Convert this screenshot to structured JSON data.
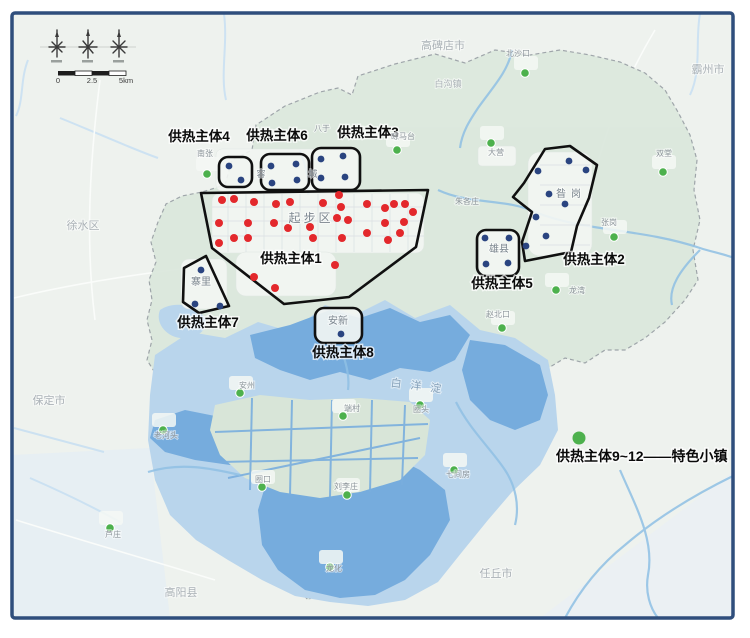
{
  "title": "雄安新区供热主体分布图",
  "colors": {
    "red": "#e3282c",
    "blue": "#2a4480",
    "green": "#4db14d",
    "outline": "#101010",
    "frame": "#2f4e7c",
    "entity_label": "#0a0a0a",
    "city_label": "#abb2b7",
    "town_label": "#8d959b",
    "inner_label": "#7b858e",
    "lake_label": "#87a2ba",
    "lake_dark": "#76acdd",
    "lake_light": "#b9d5ec",
    "region_fill": "#dce8dd"
  },
  "entities": [
    {
      "id": "1",
      "label": "供热主体1",
      "shape": "polygon",
      "points": "201,193 428,190 416,247 349,297 284,304 212,248",
      "label_x": 291,
      "label_y": 263
    },
    {
      "id": "2",
      "label": "供热主体2",
      "shape": "polygon",
      "points": "545,149 570,146 597,165 589,198 577,226 571,252 525,261 522,242 532,212 513,197 524,183",
      "label_x": 594,
      "label_y": 264
    },
    {
      "id": "3",
      "label": "供热主体3",
      "shape": "rect",
      "x": 312,
      "y": 148,
      "w": 48,
      "h": 42,
      "label_x": 368,
      "label_y": 137
    },
    {
      "id": "4",
      "label": "供热主体4",
      "shape": "rect",
      "x": 219,
      "y": 157,
      "w": 33,
      "h": 30,
      "label_x": 199,
      "label_y": 141
    },
    {
      "id": "5",
      "label": "供热主体5",
      "shape": "rect",
      "x": 477,
      "y": 230,
      "w": 42,
      "h": 46,
      "label_x": 502,
      "label_y": 288
    },
    {
      "id": "6",
      "label": "供热主体6",
      "shape": "rect",
      "x": 261,
      "y": 154,
      "w": 48,
      "h": 36,
      "label_x": 277,
      "label_y": 140
    },
    {
      "id": "7",
      "label": "供热主体7",
      "shape": "polygon",
      "points": "206,256 229,306 199,313 183,302 184,268",
      "label_x": 208,
      "label_y": 327
    },
    {
      "id": "8",
      "label": "供热主体8",
      "shape": "rect",
      "x": 315,
      "y": 308,
      "w": 47,
      "h": 35,
      "label_x": 343,
      "label_y": 357
    }
  ],
  "dots": {
    "red": [
      [
        222,
        200
      ],
      [
        234,
        199
      ],
      [
        254,
        202
      ],
      [
        276,
        204
      ],
      [
        290,
        202
      ],
      [
        323,
        203
      ],
      [
        339,
        195
      ],
      [
        341,
        207
      ],
      [
        367,
        204
      ],
      [
        385,
        208
      ],
      [
        394,
        204
      ],
      [
        405,
        204
      ],
      [
        413,
        212
      ],
      [
        219,
        223
      ],
      [
        248,
        223
      ],
      [
        274,
        223
      ],
      [
        288,
        228
      ],
      [
        310,
        227
      ],
      [
        337,
        218
      ],
      [
        348,
        220
      ],
      [
        385,
        223
      ],
      [
        404,
        222
      ],
      [
        400,
        233
      ],
      [
        219,
        243
      ],
      [
        234,
        238
      ],
      [
        248,
        238
      ],
      [
        313,
        238
      ],
      [
        342,
        238
      ],
      [
        367,
        233
      ],
      [
        388,
        240
      ],
      [
        335,
        265
      ],
      [
        254,
        277
      ],
      [
        275,
        288
      ]
    ],
    "blue": [
      [
        229,
        166
      ],
      [
        241,
        180
      ],
      [
        271,
        166
      ],
      [
        296,
        164
      ],
      [
        272,
        183
      ],
      [
        297,
        180
      ],
      [
        321,
        159
      ],
      [
        343,
        156
      ],
      [
        321,
        178
      ],
      [
        345,
        177
      ],
      [
        538,
        171
      ],
      [
        569,
        161
      ],
      [
        586,
        170
      ],
      [
        549,
        194
      ],
      [
        565,
        204
      ],
      [
        536,
        217
      ],
      [
        546,
        236
      ],
      [
        526,
        246
      ],
      [
        485,
        238
      ],
      [
        509,
        238
      ],
      [
        486,
        264
      ],
      [
        508,
        263
      ],
      [
        201,
        270
      ],
      [
        195,
        304
      ],
      [
        220,
        306
      ],
      [
        341,
        334
      ]
    ],
    "green": [
      [
        207,
        174
      ],
      [
        397,
        150
      ],
      [
        525,
        73
      ],
      [
        491,
        143
      ],
      [
        663,
        172
      ],
      [
        614,
        237
      ],
      [
        556,
        290
      ],
      [
        502,
        328
      ],
      [
        240,
        393
      ],
      [
        343,
        416
      ],
      [
        420,
        405
      ],
      [
        163,
        430
      ],
      [
        110,
        528
      ],
      [
        347,
        495
      ],
      [
        262,
        487
      ],
      [
        330,
        567
      ],
      [
        454,
        470
      ]
    ]
  },
  "place_labels": [
    {
      "t": "高碑店市",
      "x": 443,
      "y": 49,
      "s": 11,
      "c": "city"
    },
    {
      "t": "霸州市",
      "x": 708,
      "y": 73,
      "s": 11,
      "c": "city"
    },
    {
      "t": "徐水区",
      "x": 83,
      "y": 229,
      "s": 11,
      "c": "city"
    },
    {
      "t": "保定市",
      "x": 49,
      "y": 404,
      "s": 11,
      "c": "city"
    },
    {
      "t": "高阳县",
      "x": 181,
      "y": 596,
      "s": 11,
      "c": "city"
    },
    {
      "t": "任丘市",
      "x": 496,
      "y": 577,
      "s": 11,
      "c": "city"
    },
    {
      "t": "白沟镇",
      "x": 448,
      "y": 87,
      "s": 9,
      "c": "city"
    },
    {
      "t": "南张",
      "x": 205,
      "y": 156,
      "s": 8,
      "c": "town"
    },
    {
      "t": "八于",
      "x": 322,
      "y": 131,
      "s": 8,
      "c": "town"
    },
    {
      "t": "晾马台",
      "x": 403,
      "y": 139,
      "s": 8,
      "c": "town"
    },
    {
      "t": "北沙口",
      "x": 518,
      "y": 56,
      "s": 8,
      "c": "town"
    },
    {
      "t": "大营",
      "x": 496,
      "y": 155,
      "s": 8,
      "c": "town"
    },
    {
      "t": "双堂",
      "x": 664,
      "y": 156,
      "s": 8,
      "c": "town"
    },
    {
      "t": "张岗",
      "x": 609,
      "y": 225,
      "s": 8,
      "c": "town"
    },
    {
      "t": "朱各庄",
      "x": 467,
      "y": 204,
      "s": 8,
      "c": "town"
    },
    {
      "t": "龙湾",
      "x": 577,
      "y": 293,
      "s": 8,
      "c": "town"
    },
    {
      "t": "赵北口",
      "x": 498,
      "y": 317,
      "s": 8,
      "c": "town"
    },
    {
      "t": "安州",
      "x": 247,
      "y": 388,
      "s": 8,
      "c": "town"
    },
    {
      "t": "端村",
      "x": 352,
      "y": 411,
      "s": 8,
      "c": "town"
    },
    {
      "t": "圈头",
      "x": 421,
      "y": 412,
      "s": 8,
      "c": "town"
    },
    {
      "t": "七间房",
      "x": 458,
      "y": 477,
      "s": 8,
      "c": "town"
    },
    {
      "t": "刘李庄",
      "x": 346,
      "y": 489,
      "s": 8,
      "c": "town"
    },
    {
      "t": "圈口",
      "x": 263,
      "y": 482,
      "s": 8,
      "c": "town"
    },
    {
      "t": "龙化",
      "x": 334,
      "y": 571,
      "s": 8,
      "c": "town"
    },
    {
      "t": "芦庄",
      "x": 113,
      "y": 537,
      "s": 8,
      "c": "town"
    },
    {
      "t": "老河头",
      "x": 166,
      "y": 438,
      "s": 8,
      "c": "town"
    },
    {
      "t": "容",
      "x": 261,
      "y": 177,
      "s": 9,
      "c": "inner"
    },
    {
      "t": "城",
      "x": 313,
      "y": 177,
      "s": 9,
      "c": "inner"
    },
    {
      "t": "起步区",
      "x": 311,
      "y": 222,
      "s": 12,
      "c": "inner",
      "ls": 3
    },
    {
      "t": "昝岗",
      "x": 571,
      "y": 197,
      "s": 10,
      "c": "inner",
      "ls": 5
    },
    {
      "t": "雄县",
      "x": 499,
      "y": 252,
      "s": 10,
      "c": "inner"
    },
    {
      "t": "安新",
      "x": 338,
      "y": 324,
      "s": 10,
      "c": "inner"
    },
    {
      "t": "寨里",
      "x": 201,
      "y": 285,
      "s": 10,
      "c": "inner"
    },
    {
      "t": "白洋淀",
      "x": 420,
      "y": 390,
      "s": 11,
      "c": "lake",
      "ls": 9,
      "r": 7
    }
  ],
  "legend": {
    "text": "供热主体9~12——特色小镇",
    "x": 556,
    "y": 461,
    "dot": {
      "x": 579,
      "y": 438,
      "r": 6.5
    }
  },
  "scale_bar": {
    "y": 83,
    "ticks": [
      {
        "t": "0",
        "x": 58
      },
      {
        "t": "2.5",
        "x": 92
      },
      {
        "t": "5km",
        "x": 126
      }
    ]
  }
}
